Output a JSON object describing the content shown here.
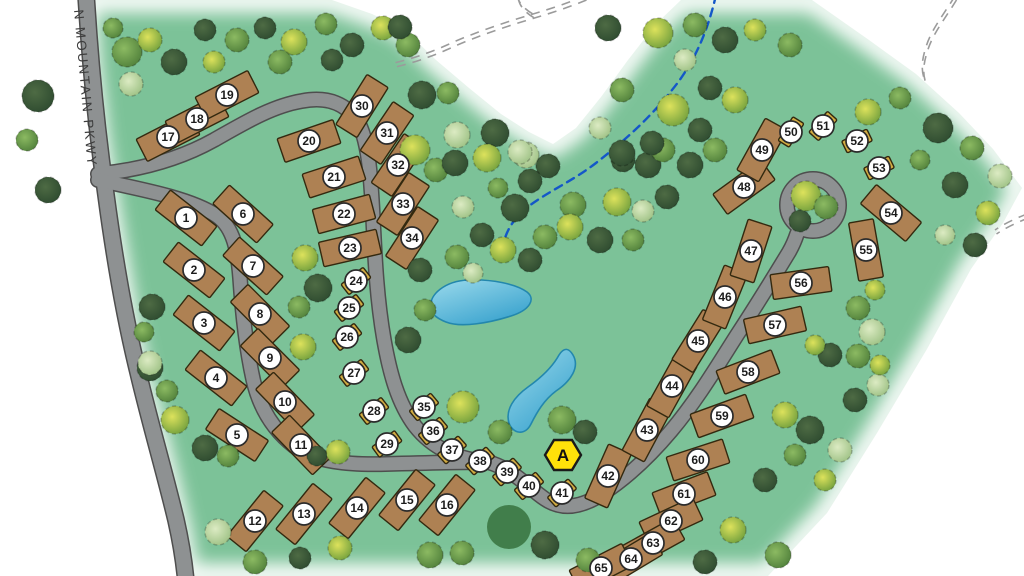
{
  "map": {
    "road_label": "N MOUNTAIN PKWY",
    "marker": {
      "x": 563,
      "y": 455,
      "label": "A"
    },
    "colors": {
      "green": "#7cc298",
      "road_fill": "#8e9192",
      "road_edge": "#4e4e4e",
      "lot_rv": "#ae8153",
      "lot_tent": "#d2ac42",
      "lot_stroke": "#33290f",
      "label_bg": "#ffffff",
      "label_stroke": "#2b2b2b",
      "label_text": "#1c1c1c",
      "marker_fill": "#ffe10a",
      "marker_stroke": "#1a1a1a",
      "pond_light": "#9bdaec",
      "pond_dark": "#3aa3ce",
      "pond_stroke": "#2387ad",
      "stream": "#1457c8",
      "trail": "#9b9b9b",
      "grove": "#3e7a47",
      "road_label_color": "#3d3d3d",
      "tree_palette": [
        [
          "#4e6b44",
          "#2d4a2f"
        ],
        [
          "#8cba62",
          "#4f7f3a"
        ],
        [
          "#dde25c",
          "#6f9e3c"
        ],
        [
          "#dcebc3",
          "#9cc083"
        ]
      ]
    },
    "outline": "M84,0 L332,0 L372,14 L404,29 L436,60 L469,88 L501,114 L529,132 L553,144 L576,128 L601,97 L628,60 L656,24 L681,0 L812,0 L869,40 L916,74 L959,113 L993,149 L1022,188 L1003,223 L971,269 L927,349 L877,433 L827,513 L768,576 L186,576 L179,534 L167,484 L153,429 L138,377 L126,321 L116,262 L106,202 L96,137 L88,67 Z",
    "roads": [
      {
        "name": "road-parkway",
        "w": 15,
        "d": "M86,-6 C90,60 96,125 106,195 C114,255 124,315 138,372 C150,423 164,470 176,520 C181,542 184,560 186,582"
      },
      {
        "name": "road-loop-north",
        "w": 13,
        "d": "M98,174 C140,170 178,160 214,140 C244,123 272,106 302,101 C328,96 348,104 359,124 C369,144 371,180 373,218 C375,260 377,300 384,340 C390,374 398,403 415,426 C433,449 459,460 490,462"
      },
      {
        "name": "road-loop-south",
        "w": 13,
        "d": "M98,180 C145,190 192,199 217,216 C234,228 238,252 240,278 C242,308 246,347 253,379 C259,406 272,429 294,446 C315,462 348,465 385,464 C420,463 455,462 490,462"
      },
      {
        "name": "road-southeast",
        "w": 13,
        "d": "M488,462 C515,470 527,487 545,499 C563,511 582,507 602,494 C628,477 650,456 671,431 C697,400 716,368 737,335 C756,306 772,280 789,252 C793,245 795,240 797,234"
      }
    ],
    "culdesac": {
      "cx": 813,
      "cy": 205,
      "r": 26,
      "island_r": 18
    },
    "stream": "M716,-5 C708,30 695,62 672,90 C649,119 624,141 596,163 C571,182 549,191 529,206 C517,215 509,226 505,238",
    "trails": [
      "M585,-4 C568,3 550,9 533,14 C503,23 473,33 447,45 C429,53 411,59 394,63",
      "M517,-5 C518,2 524,9 533,14",
      "M955,-4 C944,14 931,30 926,47 C922,59 921,69 924,78",
      "M1027,214 C1014,219 1002,225 995,230"
    ],
    "ponds": [
      "M431,309 C428,294 446,281 468,280 C492,279 516,284 527,292 C536,299 530,310 511,316 C489,323 461,328 446,322 C436,318 432,314 431,309 Z",
      "M573,355 C580,367 571,381 556,391 C544,400 537,412 531,424 C525,436 513,434 509,423 C505,410 514,397 528,387 C542,377 553,366 559,355 C564,347 569,348 573,355 Z"
    ],
    "grove": {
      "cx": 509,
      "cy": 527,
      "r": 22
    },
    "lot_sizes": {
      "rv": [
        59,
        25
      ],
      "tent": [
        28,
        13
      ]
    },
    "lots": [
      [
        1,
        186,
        218,
        38,
        "rv"
      ],
      [
        2,
        194,
        270,
        38,
        "rv"
      ],
      [
        3,
        204,
        323,
        38,
        "rv"
      ],
      [
        4,
        216,
        378,
        38,
        "rv"
      ],
      [
        5,
        237,
        435,
        33,
        "rv"
      ],
      [
        6,
        243,
        214,
        42,
        "rv"
      ],
      [
        7,
        253,
        266,
        42,
        "rv"
      ],
      [
        8,
        260,
        314,
        45,
        "rv"
      ],
      [
        9,
        270,
        358,
        45,
        "rv"
      ],
      [
        10,
        285,
        402,
        46,
        "rv"
      ],
      [
        11,
        301,
        445,
        46,
        "rv"
      ],
      [
        12,
        255,
        521,
        -51,
        "rv"
      ],
      [
        13,
        304,
        514,
        -51,
        "rv"
      ],
      [
        14,
        357,
        508,
        -51,
        "rv"
      ],
      [
        15,
        407,
        500,
        -51,
        "rv"
      ],
      [
        16,
        447,
        505,
        -51,
        "rv"
      ],
      [
        17,
        168,
        137,
        -27,
        "rv"
      ],
      [
        18,
        197,
        119,
        -27,
        "rv"
      ],
      [
        19,
        227,
        95,
        -27,
        "rv"
      ],
      [
        20,
        309,
        141,
        -19,
        "rv"
      ],
      [
        21,
        334,
        177,
        -18,
        "rv"
      ],
      [
        22,
        344,
        214,
        -15,
        "rv"
      ],
      [
        23,
        350,
        248,
        -13,
        "rv"
      ],
      [
        24,
        356,
        281,
        -38,
        "tent"
      ],
      [
        25,
        349,
        308,
        -38,
        "tent"
      ],
      [
        26,
        347,
        337,
        -38,
        "tent"
      ],
      [
        27,
        354,
        373,
        -38,
        "tent"
      ],
      [
        28,
        374,
        411,
        -38,
        "tent"
      ],
      [
        29,
        387,
        444,
        -36,
        "tent"
      ],
      [
        30,
        362,
        106,
        -58,
        "rv"
      ],
      [
        31,
        387,
        133,
        -56,
        "rv"
      ],
      [
        32,
        398,
        165,
        -56,
        "rv"
      ],
      [
        33,
        403,
        204,
        -57,
        "rv"
      ],
      [
        34,
        412,
        238,
        -57,
        "rv"
      ],
      [
        35,
        424,
        407,
        -40,
        "tent"
      ],
      [
        36,
        433,
        431,
        -40,
        "tent"
      ],
      [
        37,
        452,
        450,
        -42,
        "tent"
      ],
      [
        38,
        480,
        461,
        -42,
        "tent"
      ],
      [
        39,
        507,
        472,
        -42,
        "tent"
      ],
      [
        40,
        529,
        486,
        -40,
        "tent"
      ],
      [
        41,
        562,
        493,
        -42,
        "tent"
      ],
      [
        42,
        608,
        476,
        -66,
        "rv"
      ],
      [
        43,
        647,
        430,
        -62,
        "rv"
      ],
      [
        44,
        672,
        386,
        -61,
        "rv"
      ],
      [
        45,
        698,
        341,
        -58,
        "rv"
      ],
      [
        46,
        725,
        297,
        -68,
        "rv"
      ],
      [
        47,
        751,
        251,
        -72,
        "rv"
      ],
      [
        48,
        744,
        187,
        -36,
        "rv"
      ],
      [
        49,
        762,
        150,
        -61,
        "rv"
      ],
      [
        50,
        791,
        132,
        -58,
        "tent"
      ],
      [
        51,
        823,
        126,
        -48,
        "tent"
      ],
      [
        52,
        857,
        141,
        -26,
        "tent"
      ],
      [
        53,
        879,
        168,
        -26,
        "tent"
      ],
      [
        54,
        891,
        213,
        40,
        "rv"
      ],
      [
        55,
        866,
        250,
        80,
        "rv"
      ],
      [
        56,
        801,
        283,
        -8,
        "rv"
      ],
      [
        57,
        775,
        325,
        -13,
        "rv"
      ],
      [
        58,
        748,
        372,
        -21,
        "rv"
      ],
      [
        59,
        722,
        416,
        -20,
        "rv"
      ],
      [
        60,
        698,
        460,
        -18,
        "rv"
      ],
      [
        61,
        684,
        494,
        -21,
        "rv"
      ],
      [
        62,
        671,
        521,
        -25,
        "rv"
      ],
      [
        63,
        653,
        543,
        -29,
        "rv"
      ],
      [
        64,
        631,
        559,
        -31,
        "rv"
      ],
      [
        65,
        601,
        568,
        -27,
        "rv"
      ]
    ],
    "trees": [
      [
        38,
        96,
        16,
        0
      ],
      [
        27,
        140,
        11,
        1
      ],
      [
        48,
        190,
        13,
        0
      ],
      [
        150,
        368,
        13,
        0
      ],
      [
        167,
        391,
        11,
        1
      ],
      [
        113,
        28,
        10,
        1
      ],
      [
        127,
        52,
        15,
        1
      ],
      [
        150,
        40,
        12,
        2
      ],
      [
        174,
        62,
        13,
        0
      ],
      [
        131,
        84,
        12,
        3
      ],
      [
        205,
        30,
        11,
        0
      ],
      [
        237,
        40,
        12,
        1
      ],
      [
        265,
        28,
        11,
        0
      ],
      [
        294,
        42,
        13,
        2
      ],
      [
        326,
        24,
        11,
        1
      ],
      [
        352,
        45,
        12,
        0
      ],
      [
        383,
        28,
        12,
        2
      ],
      [
        408,
        45,
        12,
        1
      ],
      [
        400,
        27,
        12,
        0
      ],
      [
        214,
        62,
        11,
        2
      ],
      [
        280,
        62,
        12,
        1
      ],
      [
        332,
        60,
        11,
        0
      ],
      [
        415,
        150,
        15,
        2
      ],
      [
        436,
        170,
        12,
        1
      ],
      [
        305,
        258,
        13,
        2
      ],
      [
        318,
        288,
        14,
        0
      ],
      [
        299,
        307,
        11,
        1
      ],
      [
        152,
        307,
        13,
        0
      ],
      [
        144,
        332,
        10,
        1
      ],
      [
        150,
        363,
        12,
        3
      ],
      [
        175,
        420,
        14,
        2
      ],
      [
        205,
        448,
        13,
        0
      ],
      [
        228,
        456,
        11,
        1
      ],
      [
        303,
        347,
        13,
        2
      ],
      [
        338,
        452,
        12,
        2
      ],
      [
        317,
        456,
        10,
        0
      ],
      [
        422,
        95,
        14,
        0
      ],
      [
        448,
        93,
        11,
        1
      ],
      [
        457,
        135,
        13,
        3
      ],
      [
        495,
        133,
        14,
        0
      ],
      [
        526,
        155,
        13,
        3
      ],
      [
        455,
        163,
        13,
        0
      ],
      [
        487,
        158,
        14,
        2
      ],
      [
        520,
        152,
        12,
        3
      ],
      [
        548,
        166,
        12,
        0
      ],
      [
        530,
        181,
        12,
        0
      ],
      [
        498,
        188,
        10,
        1
      ],
      [
        463,
        207,
        11,
        3
      ],
      [
        515,
        208,
        14,
        0
      ],
      [
        573,
        205,
        13,
        1
      ],
      [
        617,
        202,
        14,
        2
      ],
      [
        648,
        165,
        13,
        0
      ],
      [
        663,
        150,
        12,
        1
      ],
      [
        623,
        160,
        12,
        0
      ],
      [
        643,
        211,
        11,
        3
      ],
      [
        667,
        197,
        12,
        0
      ],
      [
        545,
        237,
        12,
        1
      ],
      [
        570,
        227,
        13,
        2
      ],
      [
        530,
        260,
        12,
        0
      ],
      [
        503,
        250,
        13,
        2
      ],
      [
        600,
        240,
        13,
        0
      ],
      [
        633,
        240,
        11,
        1
      ],
      [
        482,
        235,
        12,
        0
      ],
      [
        457,
        257,
        12,
        1
      ],
      [
        473,
        273,
        10,
        3
      ],
      [
        420,
        270,
        12,
        0
      ],
      [
        408,
        340,
        13,
        0
      ],
      [
        425,
        310,
        11,
        1
      ],
      [
        608,
        28,
        13,
        0
      ],
      [
        658,
        33,
        15,
        2
      ],
      [
        673,
        110,
        16,
        2
      ],
      [
        622,
        90,
        12,
        1
      ],
      [
        600,
        128,
        11,
        3
      ],
      [
        622,
        153,
        13,
        0
      ],
      [
        652,
        143,
        12,
        0
      ],
      [
        695,
        25,
        12,
        1
      ],
      [
        725,
        40,
        13,
        0
      ],
      [
        755,
        30,
        11,
        2
      ],
      [
        790,
        45,
        12,
        1
      ],
      [
        685,
        60,
        11,
        3
      ],
      [
        700,
        130,
        12,
        0
      ],
      [
        690,
        165,
        13,
        0
      ],
      [
        715,
        150,
        12,
        1
      ],
      [
        735,
        100,
        13,
        2
      ],
      [
        710,
        88,
        12,
        0
      ],
      [
        868,
        112,
        13,
        2
      ],
      [
        900,
        98,
        11,
        1
      ],
      [
        938,
        128,
        15,
        0
      ],
      [
        972,
        148,
        12,
        1
      ],
      [
        1000,
        176,
        12,
        3
      ],
      [
        955,
        185,
        13,
        0
      ],
      [
        988,
        213,
        12,
        2
      ],
      [
        975,
        245,
        12,
        0
      ],
      [
        945,
        235,
        10,
        3
      ],
      [
        920,
        160,
        10,
        1
      ],
      [
        806,
        196,
        15,
        2
      ],
      [
        826,
        207,
        12,
        1
      ],
      [
        800,
        221,
        11,
        0
      ],
      [
        875,
        290,
        10,
        2
      ],
      [
        858,
        308,
        12,
        1
      ],
      [
        872,
        332,
        13,
        3
      ],
      [
        858,
        356,
        12,
        1
      ],
      [
        878,
        385,
        11,
        3
      ],
      [
        855,
        400,
        12,
        0
      ],
      [
        830,
        355,
        12,
        0
      ],
      [
        880,
        365,
        10,
        2
      ],
      [
        815,
        345,
        10,
        2
      ],
      [
        785,
        415,
        13,
        2
      ],
      [
        810,
        430,
        14,
        0
      ],
      [
        840,
        450,
        12,
        3
      ],
      [
        795,
        455,
        11,
        1
      ],
      [
        765,
        480,
        12,
        0
      ],
      [
        825,
        480,
        11,
        2
      ],
      [
        218,
        532,
        13,
        3
      ],
      [
        255,
        562,
        12,
        1
      ],
      [
        300,
        558,
        11,
        0
      ],
      [
        340,
        548,
        12,
        2
      ],
      [
        430,
        555,
        13,
        1
      ],
      [
        462,
        553,
        12,
        1
      ],
      [
        545,
        545,
        14,
        0
      ],
      [
        588,
        560,
        12,
        1
      ],
      [
        705,
        562,
        12,
        0
      ],
      [
        733,
        530,
        13,
        2
      ],
      [
        778,
        555,
        13,
        1
      ],
      [
        562,
        420,
        14,
        1
      ],
      [
        585,
        432,
        12,
        0
      ],
      [
        500,
        432,
        12,
        1
      ],
      [
        463,
        407,
        16,
        2
      ]
    ]
  }
}
